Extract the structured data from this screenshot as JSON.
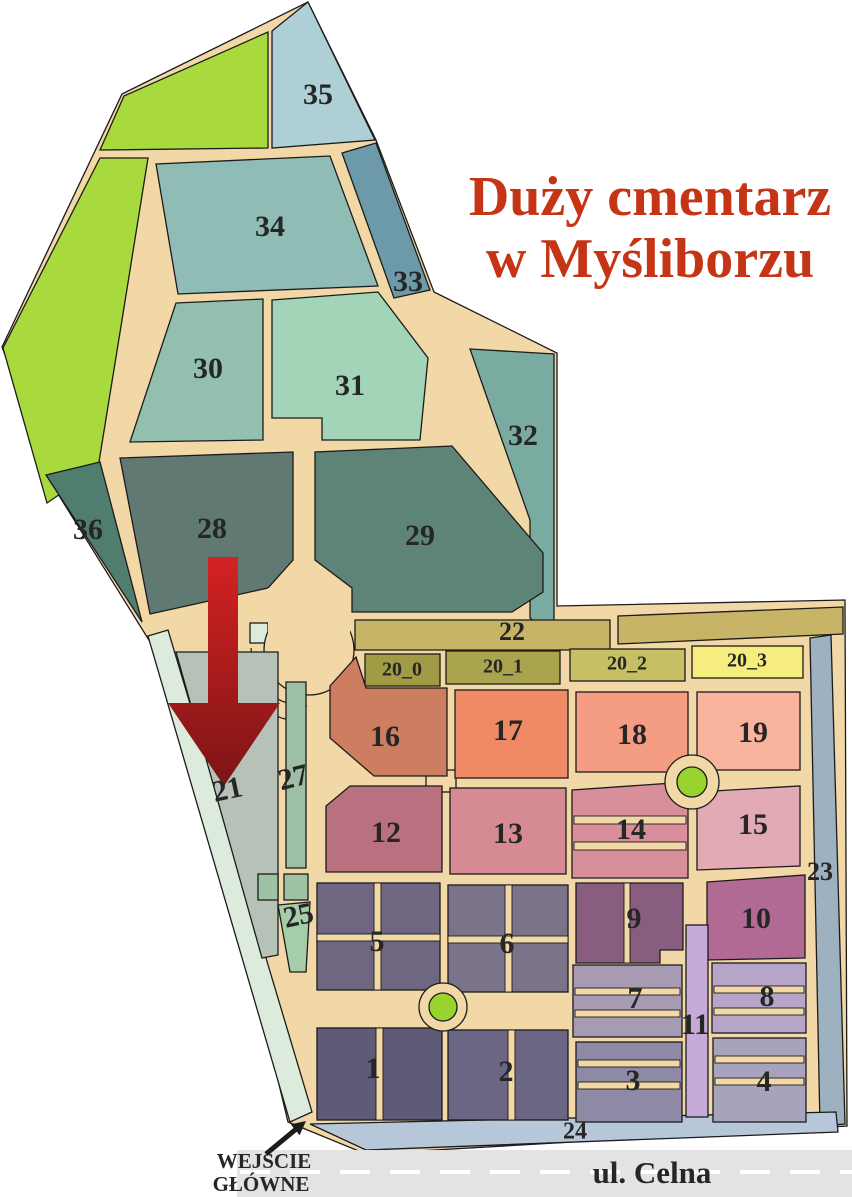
{
  "title": {
    "line1": "Duży cmentarz",
    "line2": "w Myśliborzu",
    "color": "#c53414"
  },
  "entrance": {
    "line1": "WEJŚCIE",
    "line2": "GŁÓWNE",
    "arrow_color": "#1c1c1c"
  },
  "street": {
    "name": "ul. Celna",
    "color": "#e3e3e3",
    "dash_color": "#ffffff"
  },
  "palette": {
    "path_base": "#f2d7a7",
    "green_area": "#a8da3e",
    "mint_edge": "#dcebdc",
    "mint_cell": "#9fc2a4",
    "roundabout_green": "#99d42e",
    "arrow_top": "#d42222",
    "arrow_bottom": "#7d1515",
    "label_color": "#262626",
    "outline": "#1b1b1b"
  },
  "sections": {
    "s1": {
      "label": "1",
      "color": "#5f5a77"
    },
    "s2": {
      "label": "2",
      "color": "#6b6683"
    },
    "s3": {
      "label": "3",
      "color": "#8e8aa6"
    },
    "s4": {
      "label": "4",
      "color": "#a7a3bd"
    },
    "s5": {
      "label": "5",
      "color": "#6f6781"
    },
    "s6": {
      "label": "6",
      "color": "#7b7389"
    },
    "s7": {
      "label": "7",
      "color": "#a79bb3"
    },
    "s8": {
      "label": "8",
      "color": "#b7a5c9"
    },
    "s9": {
      "label": "9",
      "color": "#885d80"
    },
    "s10": {
      "label": "10",
      "color": "#b06a93"
    },
    "s11": {
      "label": "11",
      "color": "#c6abd8"
    },
    "s12": {
      "label": "12",
      "color": "#b9707f"
    },
    "s13": {
      "label": "13",
      "color": "#d68b94"
    },
    "s14": {
      "label": "14",
      "color": "#d98f9b"
    },
    "s15": {
      "label": "15",
      "color": "#e2aab4"
    },
    "s16": {
      "label": "16",
      "color": "#cd7e61"
    },
    "s17": {
      "label": "17",
      "color": "#f08a66"
    },
    "s18": {
      "label": "18",
      "color": "#f59d82"
    },
    "s19": {
      "label": "19",
      "color": "#f9b49e"
    },
    "s20_0": {
      "label": "20_0",
      "color": "#a19b45"
    },
    "s20_1": {
      "label": "20_1",
      "color": "#aaa44e"
    },
    "s20_2": {
      "label": "20_2",
      "color": "#c6bf63"
    },
    "s20_3": {
      "label": "20_3",
      "color": "#f5ee7e"
    },
    "s21": {
      "label": "21",
      "color": "#b6c2b8"
    },
    "s22": {
      "label": "22",
      "color": "#c8b467"
    },
    "s23": {
      "label": "23",
      "color": "#9eb1c0"
    },
    "s24": {
      "label": "24",
      "color": "#b7c7da"
    },
    "s25": {
      "label": "25",
      "color": "#a5cda7"
    },
    "s27": {
      "label": "27",
      "color": "#9dbfa5"
    },
    "s28": {
      "label": "28",
      "color": "#607973"
    },
    "s29": {
      "label": "29",
      "color": "#5e8477"
    },
    "s30": {
      "label": "30",
      "color": "#93bfae"
    },
    "s31": {
      "label": "31",
      "color": "#a2d4b8"
    },
    "s32": {
      "label": "32",
      "color": "#79aba0"
    },
    "s33": {
      "label": "33",
      "color": "#6d9aa8"
    },
    "s34": {
      "label": "34",
      "color": "#8fbcb4"
    },
    "s35": {
      "label": "35",
      "color": "#aecfd6"
    },
    "s36": {
      "label": "36",
      "color": "#4f7d6e"
    }
  }
}
